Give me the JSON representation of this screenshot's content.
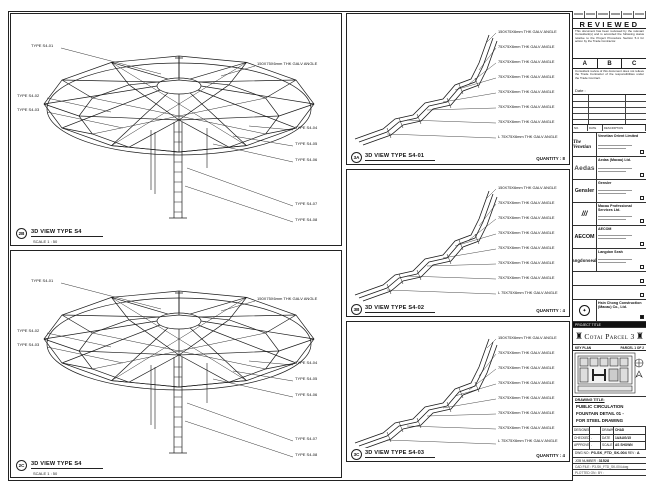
{
  "panels": {
    "left_top": {
      "ref": "2B",
      "title": "3D VIEW TYPE S4",
      "scale": "SCALE 1 : 50",
      "callouts": [
        "TYPE S4-01",
        "TYPE S4-02",
        "TYPE S4-03",
        "150X75X6mm THK GALV ANGLE",
        "TYPE S4-04",
        "TYPE S4-05",
        "TYPE S4-06",
        "TYPE S4-07",
        "TYPE S4-08"
      ]
    },
    "left_bottom": {
      "ref": "2C",
      "title": "3D VIEW TYPE S4",
      "scale": "SCALE 1 : 50",
      "callouts": [
        "TYPE S4-01",
        "TYPE S4-02",
        "TYPE S4-03",
        "150X75X6mm THK GALV ANGLE",
        "TYPE S4-04",
        "TYPE S4-05",
        "TYPE S4-06",
        "TYPE S4-07",
        "TYPE S4-08"
      ]
    },
    "mid": [
      {
        "ref": "3A",
        "title": "3D VIEW TYPE S4-01",
        "quantity": "QUANTITY : 8",
        "labels": [
          "150X75X6mm THK GALV ANGLE",
          "75X75X6mm THK GALV ANGLE",
          "75X75X6mm THK GALV ANGLE",
          "75X75X6mm THK GALV ANGLE",
          "75X75X6mm THK GALV ANGLE",
          "75X75X6mm THK GALV ANGLE",
          "75X75X6mm THK GALV ANGLE",
          "L 75X75X6mm THK GALV ANGLE"
        ]
      },
      {
        "ref": "3B",
        "title": "3D VIEW TYPE S4-02",
        "quantity": "QUANTITY : 4",
        "labels": [
          "150X75X6mm THK GALV ANGLE",
          "75X75X6mm THK GALV ANGLE",
          "75X75X6mm THK GALV ANGLE",
          "75X75X6mm THK GALV ANGLE",
          "75X75X6mm THK GALV ANGLE",
          "75X75X6mm THK GALV ANGLE",
          "75X75X6mm THK GALV ANGLE",
          "L 75X75X6mm THK GALV ANGLE"
        ]
      },
      {
        "ref": "3C",
        "title": "3D VIEW TYPE S4-03",
        "quantity": "QUANTITY : 4",
        "labels": [
          "150X75X6mm THK GALV ANGLE",
          "75X75X6mm THK GALV ANGLE",
          "75X75X6mm THK GALV ANGLE",
          "75X75X6mm THK GALV ANGLE",
          "75X75X6mm THK GALV ANGLE",
          "75X75X6mm THK GALV ANGLE",
          "75X75X6mm THK GALV ANGLE",
          "L 75X75X6mm THK GALV ANGLE"
        ]
      }
    ]
  },
  "title_block": {
    "reviewed": {
      "title": "REVIEWED",
      "body1": "This document has been reviewed by the relevant Consultant(s) and is accorded the following status relative to the Project Procedure Section 5.4 for action by the Trade Contractor.",
      "grades": [
        "A",
        "B",
        "C"
      ],
      "body2": "Consultant review of this document does not relieve the Trade Contractor of the responsibilities under the Trade Contract.",
      "date_label": "Date :"
    },
    "rev_header": {
      "no": "NO.",
      "date": "DATE",
      "desc": "DESCRIPTION"
    },
    "companies": [
      {
        "logo": "The Venetian",
        "name": "Venetian Orient Limited"
      },
      {
        "logo": "Aedas",
        "name": "Aedas (Macau) Ltd."
      },
      {
        "logo": "Gensler",
        "name": "Gensler"
      },
      {
        "logo": "///",
        "name": "Macau Professional Services Ltd."
      },
      {
        "logo": "AECOM",
        "name": "AECOM"
      },
      {
        "logo": "langdonseah",
        "name": "Langdon Seah"
      },
      {
        "logo": "",
        "name": ""
      },
      {
        "logo": "",
        "name": ""
      },
      {
        "logo": "HC",
        "name": "Hsin Chong Construction (Macau) Co., Ltd."
      }
    ],
    "project_strip": "PROJECT TITLE",
    "project_name": "Cotai Parcel 3",
    "key_plan": {
      "label": "KEY PLAN",
      "right": "PARCEL 1 OF 2"
    },
    "drawing_title": {
      "label": "DRAWING TITLE:",
      "line1": "PUBLIC CIRCULATION",
      "line2": "FOUNTAIN DETAIL 01 -",
      "line3": "FOR STEEL DRAWING"
    },
    "info": {
      "r1c1": "DESIGNED",
      "r1c2": "",
      "r1c3": "DRAWN",
      "r1c4": "CHAD",
      "r2c1": "CHECKED",
      "r2c2": "-",
      "r2c3": "DATE",
      "r2c4": "14/AUG/15",
      "r3c1": "APPROVED",
      "r3c2": "-",
      "r3c3": "SCALE",
      "r3c4": "AS SHOWN"
    },
    "dwg": {
      "label": "DWG NO :",
      "value": "P3-SK_FTD_SK-004",
      "rev_label": "REV :",
      "rev": "A"
    },
    "job": {
      "label": "JOB NUMBER :",
      "value": "31528"
    },
    "file": {
      "label": "CAD FILE :",
      "value": "P3-SK_FTD_SK-004.dwg"
    },
    "plot": {
      "label": "PLOTTED ON :",
      "value": "BY :"
    }
  }
}
